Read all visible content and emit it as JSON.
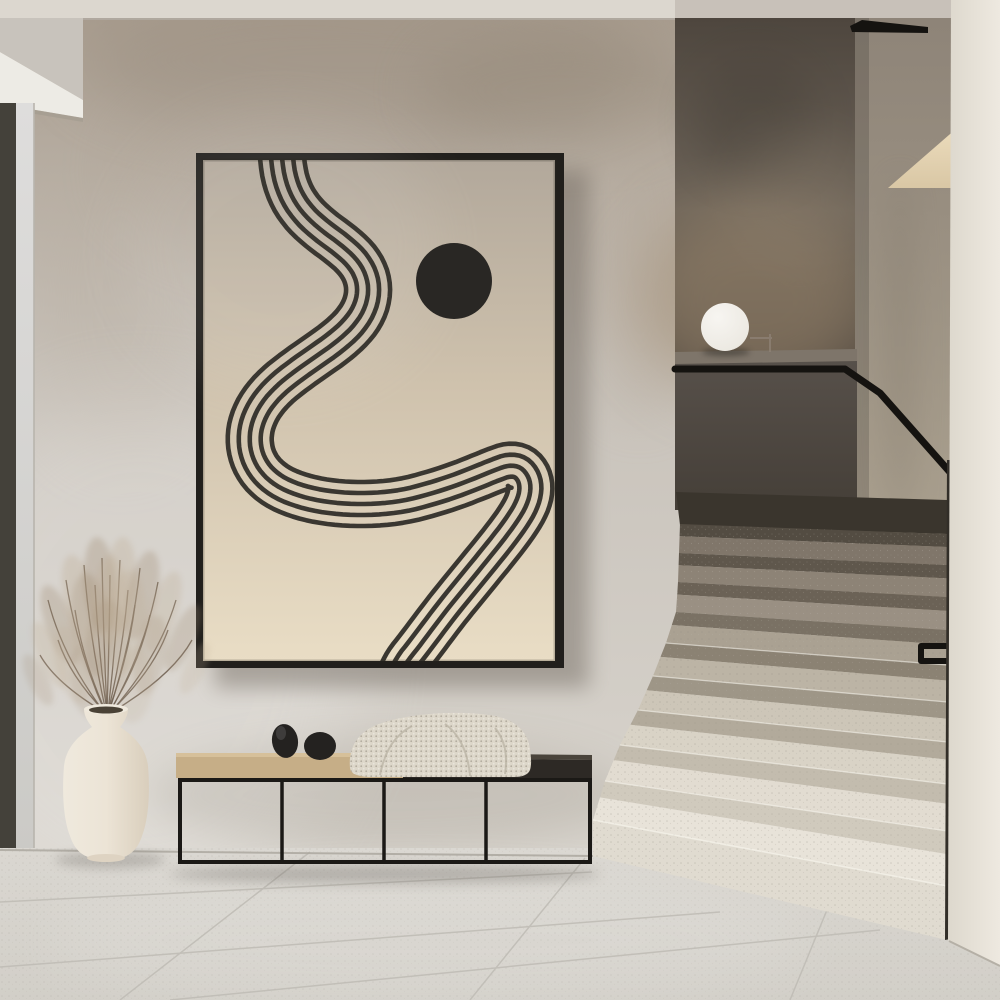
{
  "colors": {
    "ceiling": "#dcd7cf",
    "ceiling_shadow": "#b3aea6",
    "soffit_face": "#c8c3bc",
    "soffit_under": "#edebe5",
    "wall_top_smudge": "#a89c8e",
    "wall_mid": "#c8c2ba",
    "wall_low": "#d8d4cd",
    "door_frame": "#44413a",
    "glass_hi": "#dedddc",
    "glass_lo": "#cbcac6",
    "stair_back_hi": "#6d6459",
    "stair_back_lo": "#4e463e",
    "glow": "#a08b70",
    "right_wall_hi": "#8e8478",
    "right_wall_lo": "#b3a996",
    "wedge_hi": "#ecdcbc",
    "wedge_lo": "#d9c7a5",
    "parapet_hi": "#57504a",
    "parapet_lo": "#453f38",
    "ledge_top": "#7e756a",
    "rail": "#151310",
    "under_landing_shadow": "#3a352d",
    "sphere_hi": "#f7f5f1",
    "sphere_lo": "#cfc9bf",
    "lamp_stand": "#8d8174",
    "pillar_l": "#ddd8cd",
    "pillar_r": "#eee9e0",
    "gap": "#322e28",
    "floor_hi": "#dad7d1",
    "floor_lo": "#d2cfc8",
    "grout": "#c0bdb6",
    "frame": "#211f1c",
    "art_top": "#b2a89b",
    "art_mid": "#cfc2ad",
    "art_bottom": "#e9ddc5",
    "ribbon": "#3a3731",
    "dot": "#292724",
    "bench_frame": "#1b1916",
    "wood_top": "#d6c09a",
    "wood_front": "#c6ae87",
    "dark_top_hi": "#4a443b",
    "dark_top": "#2d2925",
    "blanket": "#ddd7ca",
    "blanket_lo": "#b8b1a2",
    "pebble": "#242220",
    "vase_l": "#efe9dd",
    "vase_m": "#ece4d6",
    "vase_r": "#d9cebc",
    "vase_mouth": "#4a4236",
    "stem": "#6f6152",
    "plume_a": "#a18d75",
    "plume_b": "#bfae96"
  },
  "artwork": {
    "circle": {
      "cx": 454,
      "cy": 281,
      "r": 38
    },
    "ribbon": {
      "stroke_width": 4.6,
      "offsets": [
        -22,
        -11,
        0,
        11,
        22
      ],
      "points": [
        [
          281,
          148
        ],
        [
          284,
          176
        ],
        [
          292,
          198
        ],
        [
          305,
          216
        ],
        [
          322,
          231
        ],
        [
          340,
          244
        ],
        [
          356,
          258
        ],
        [
          366,
          274
        ],
        [
          369,
          292
        ],
        [
          364,
          311
        ],
        [
          352,
          328
        ],
        [
          335,
          343
        ],
        [
          315,
          357
        ],
        [
          295,
          371
        ],
        [
          276,
          386
        ],
        [
          261,
          403
        ],
        [
          252,
          421
        ],
        [
          249,
          439
        ],
        [
          252,
          457
        ],
        [
          261,
          473
        ],
        [
          276,
          486
        ],
        [
          296,
          495
        ],
        [
          320,
          501
        ],
        [
          347,
          504
        ],
        [
          375,
          504
        ],
        [
          403,
          501
        ],
        [
          430,
          494
        ],
        [
          455,
          486
        ],
        [
          478,
          477
        ],
        [
          495,
          470
        ],
        [
          509,
          465
        ],
        [
          521,
          467
        ],
        [
          529,
          477
        ],
        [
          531,
          490
        ],
        [
          527,
          505
        ],
        [
          517,
          522
        ],
        [
          502,
          542
        ],
        [
          485,
          563
        ],
        [
          467,
          585
        ],
        [
          449,
          607
        ],
        [
          433,
          628
        ],
        [
          418,
          648
        ],
        [
          406,
          663
        ],
        [
          399,
          678
        ]
      ]
    }
  },
  "stairs": {
    "xR": 947,
    "riser_frac": 0.42,
    "edges": [
      [
        680,
        524,
        534
      ],
      [
        679,
        553,
        565
      ],
      [
        678,
        582,
        597
      ],
      [
        676,
        612,
        630
      ],
      [
        666,
        643,
        665
      ],
      [
        653,
        676,
        702
      ],
      [
        638,
        710,
        742
      ],
      [
        620,
        745,
        784
      ],
      [
        605,
        781,
        831
      ],
      [
        593,
        820,
        886
      ]
    ],
    "base": [
      593,
      856,
      947,
      940
    ],
    "bands": [
      {
        "riser": "#534c42",
        "tread": "#80766a"
      },
      {
        "riser": "#5f574c",
        "tread": "#8d8376"
      },
      {
        "riser": "#6b6256",
        "tread": "#9a9083"
      },
      {
        "riser": "#7a7164",
        "tread": "#aaa192"
      },
      {
        "riser": "#8b8273",
        "tread": "#bcb4a5"
      },
      {
        "riser": "#9e9687",
        "tread": "#cdc6b8"
      },
      {
        "riser": "#b2aa9b",
        "tread": "#d9d3c6"
      },
      {
        "riser": "#c3bcae",
        "tread": "#e2dcd1"
      },
      {
        "riser": "#d0cabd",
        "tread": "#e8e3d9"
      }
    ],
    "face": "#e0dbd0"
  },
  "grass": {
    "stems": [
      [
        104,
        712,
        48,
        600
      ],
      [
        105,
        712,
        66,
        580
      ],
      [
        106,
        712,
        84,
        565
      ],
      [
        107,
        712,
        102,
        558
      ],
      [
        108,
        712,
        120,
        560
      ],
      [
        109,
        712,
        140,
        568
      ],
      [
        110,
        712,
        158,
        582
      ],
      [
        111,
        712,
        176,
        600
      ],
      [
        105,
        712,
        58,
        640
      ],
      [
        109,
        712,
        150,
        615
      ],
      [
        107,
        712,
        95,
        585
      ],
      [
        108,
        712,
        128,
        590
      ],
      [
        104,
        712,
        40,
        655
      ],
      [
        112,
        712,
        192,
        640
      ],
      [
        106,
        712,
        75,
        610
      ],
      [
        110,
        712,
        168,
        630
      ],
      [
        107,
        712,
        110,
        575
      ],
      [
        108,
        712,
        135,
        605
      ]
    ],
    "plumes": [
      [
        60,
        625,
        14,
        42,
        -20,
        0.3,
        0
      ],
      [
        80,
        600,
        16,
        46,
        -12,
        0.32,
        1
      ],
      [
        100,
        585,
        16,
        48,
        -4,
        0.32,
        0
      ],
      [
        120,
        585,
        16,
        48,
        4,
        0.3,
        1
      ],
      [
        142,
        595,
        15,
        45,
        12,
        0.3,
        0
      ],
      [
        163,
        612,
        14,
        42,
        18,
        0.28,
        1
      ],
      [
        50,
        655,
        12,
        36,
        -24,
        0.26,
        1
      ],
      [
        183,
        638,
        12,
        36,
        24,
        0.26,
        0
      ],
      [
        92,
        625,
        20,
        52,
        -8,
        0.24,
        0
      ],
      [
        126,
        622,
        20,
        52,
        4,
        0.24,
        1
      ],
      [
        108,
        650,
        22,
        50,
        0,
        0.22,
        0
      ],
      [
        72,
        665,
        16,
        40,
        -14,
        0.22,
        1
      ],
      [
        150,
        655,
        16,
        40,
        10,
        0.22,
        0
      ],
      [
        110,
        600,
        18,
        44,
        0,
        0.26,
        1
      ],
      [
        38,
        680,
        10,
        28,
        -26,
        0.2,
        0
      ],
      [
        195,
        668,
        10,
        28,
        26,
        0.2,
        1
      ],
      [
        88,
        680,
        18,
        38,
        -6,
        0.18,
        0
      ],
      [
        135,
        685,
        18,
        38,
        6,
        0.18,
        1
      ]
    ]
  }
}
